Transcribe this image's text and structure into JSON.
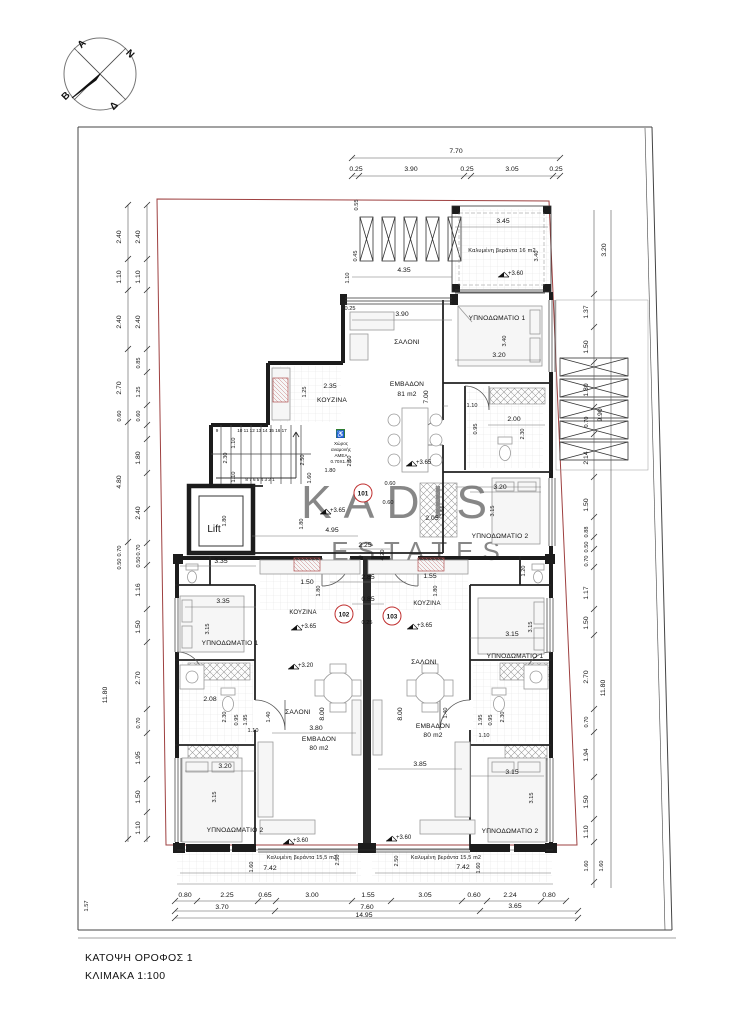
{
  "titleblock": {
    "line1": "ΚΑΤΟΨΗ  ΟΡΟΦΟΣ 1",
    "line2": "ΚΛΙΜΑΚΑ 1:100"
  },
  "watermark": {
    "line1": "KADIS",
    "line2": "ESTATES"
  },
  "compass": {
    "a": "A",
    "n": "N",
    "b": "B",
    "d": "Δ"
  },
  "units": {
    "u101": "101",
    "u102": "102",
    "u103": "103"
  },
  "rooms": {
    "living": "ΣΑΛΟΝΙ",
    "kitchen": "ΚΟΥΖΙΝΑ",
    "bed1": "ΥΠΝΟΔΩΜΑΤΙΟ 1",
    "bed2": "ΥΠΝΟΔΩΜΑΤΙΟ 2",
    "area": "ΕΜΒΑΔΟΝ",
    "area81": "81 m2",
    "area80": "80 m2",
    "veranda16": "Καλυμένη βεράντα 16 m2",
    "veranda155": "Καλυμένη βεράντα 15,5 m2",
    "lift": "Lift"
  },
  "amea": {
    "l1": "Χώρος",
    "l2": "αναμονής",
    "l3": "ΑΜΕΑ",
    "l4": "0.70X1.40"
  },
  "levels": {
    "p360": "+3.60",
    "p365": "+3.65",
    "p320": "+3.20"
  },
  "stairs": {
    "top": "10 11 12 13 14 15 16 17",
    "bottom": "8  7 6  5  4  3  2  1",
    "left": "9"
  },
  "dims": {
    "d025": "0.25",
    "d045": "0.45",
    "d050": "0.50",
    "d055": "0.55",
    "d060": "0.60",
    "d065": "0.65",
    "d070": "0.70",
    "d080": "0.80",
    "d085": "0.85",
    "d088": "0.88",
    "d095": "0.95",
    "d110": "1.10",
    "d116": "1.16",
    "d117": "1.17",
    "d120": "1.20",
    "d125": "1.25",
    "d137": "1.37",
    "d140": "1.40",
    "d150": "1.50",
    "d155": "1.55",
    "d157": "1.57",
    "d160": "1.60",
    "d180": "1.80",
    "d194": "1.94",
    "d195": "1.95",
    "d200": "2.00",
    "d205": "2.05",
    "d208": "2.08",
    "d214": "2.14",
    "d224": "2.24",
    "d225": "2.25",
    "d230": "2.30",
    "d235": "2.35",
    "d240": "2.40",
    "d250": "2.50",
    "d255": "2.55",
    "d270": "2.70",
    "d285": "2.85",
    "d300": "3.00",
    "d305": "3.05",
    "d315": "3.15",
    "d320": "3.20",
    "d335": "3.35",
    "d340": "3.40",
    "d345": "3.45",
    "d365": "3.65",
    "d370": "3.70",
    "d380": "3.80",
    "d385": "3.85",
    "d390": "3.90",
    "d420": "4.20",
    "d435": "4.35",
    "d480": "4.80",
    "d495": "4.95",
    "d700": "7.00",
    "d742": "7.42",
    "d760": "7.60",
    "d770": "7.70",
    "d800": "8.00",
    "d990": "9.90",
    "d1180": "11.80",
    "d1495": "14.95"
  },
  "colors": {
    "boundary_red": "#9e4040",
    "unit_red": "#c03030",
    "amea_green": "#2f7d32",
    "watermark_gray": "#d6d6d6",
    "wall_dark": "#1c1c1c"
  }
}
